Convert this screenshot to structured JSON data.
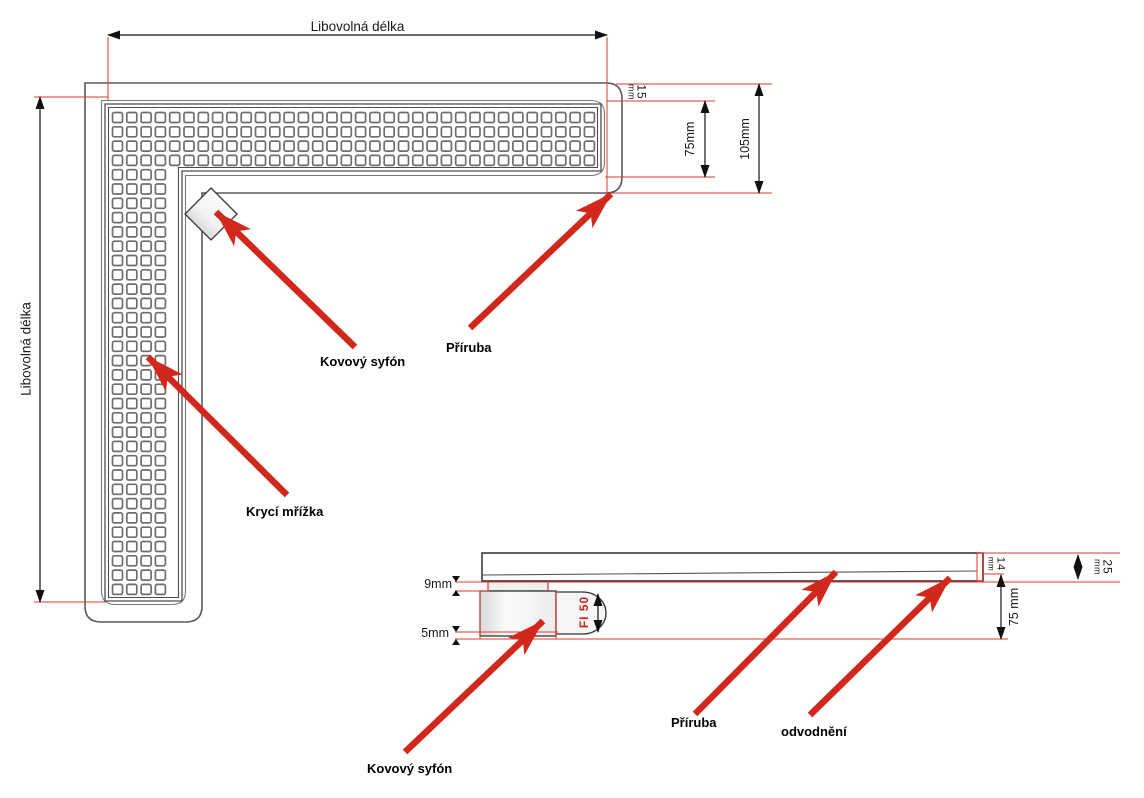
{
  "plan": {
    "dim_length_top": "Libovolná délka",
    "dim_length_left": "Libovolná délka",
    "dim_flange_value": "15",
    "dim_flange_unit": "mm",
    "dim_grate": "75mm",
    "dim_total": "105mm",
    "label_siphon": "Kovový syfón",
    "label_flange": "Příruba",
    "label_grate": "Krycí mřížka"
  },
  "side": {
    "dim_neck": "9mm",
    "dim_lip": "5mm",
    "dim_pipe": "FI 50",
    "dim_end_value": "14",
    "dim_end_unit": "mm",
    "dim_height_value": "25",
    "dim_height_unit": "mm",
    "dim_depth": "75 mm",
    "label_flange": "Příruba",
    "label_drain": "odvodnění",
    "label_siphon": "Kovový syfón"
  },
  "colors": {
    "annotation_arrow_red": "#d2281c",
    "extension_line_red": "#e03a2c",
    "outline_gray": "#5a5a5a",
    "dimension_black": "#111111"
  }
}
